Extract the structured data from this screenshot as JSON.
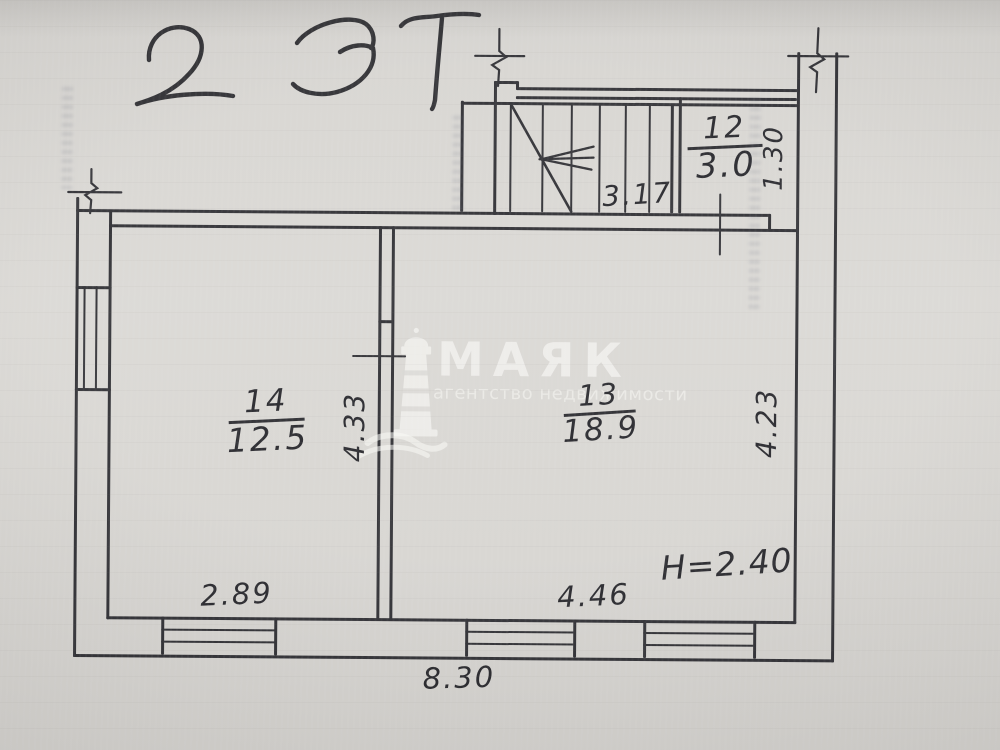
{
  "handwriting": {
    "text": "2 ЭТ"
  },
  "watermark": {
    "brand": "МАЯК",
    "tagline": "агентство недвижимости"
  },
  "rooms": [
    {
      "number": "12",
      "area": "3.0"
    },
    {
      "number": "13",
      "area": "18.9"
    },
    {
      "number": "14",
      "area": "12.5"
    }
  ],
  "dimensions": {
    "stair_length": "3.17",
    "room12_width": "1.30",
    "left_height": "4.33",
    "right_height": "4.23",
    "room14_width": "2.89",
    "room13_width": "4.46",
    "ceiling_height": "H=2.40",
    "overall_width": "8.30"
  },
  "colors": {
    "ink": "#26262b",
    "paper": "#d7d5d1",
    "watermark": "#f5f4f1"
  }
}
